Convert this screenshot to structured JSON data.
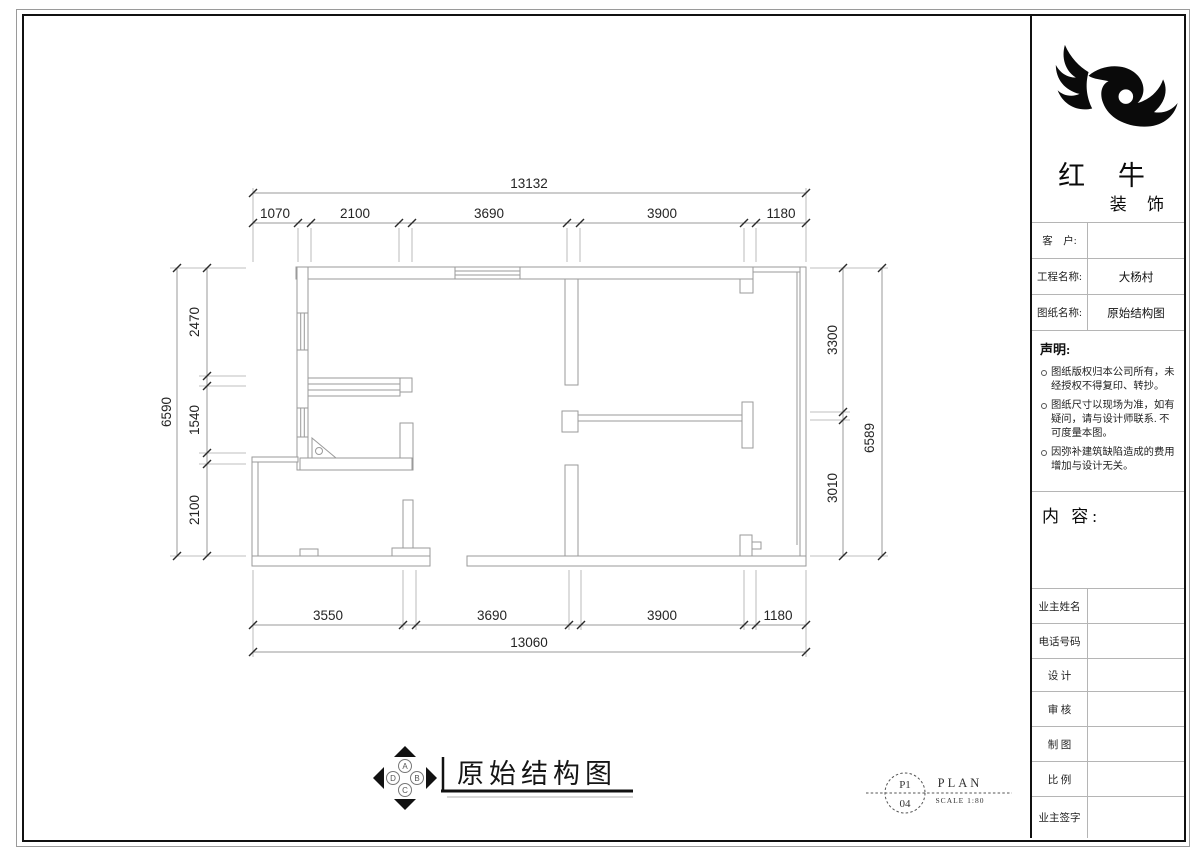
{
  "title_block": {
    "company": {
      "main": "红 牛",
      "sub": "装 饰"
    },
    "fields": [
      {
        "label": "客　户:",
        "value": ""
      },
      {
        "label": "工程名称:",
        "value": "大杨村"
      },
      {
        "label": "图纸名称:",
        "value": "原始结构图"
      }
    ],
    "statement": {
      "heading": "声明:",
      "items": [
        "图纸版权归本公司所有，未经授权不得复印、转抄。",
        "图纸尺寸以现场为准，如有疑问，请与设计师联系. 不可度量本图。",
        "因弥补建筑缺陷造成的费用增加与设计无关。"
      ]
    },
    "content_heading": "内 容:",
    "signature_rows": [
      {
        "label": "业主姓名",
        "value": ""
      },
      {
        "label": "电话号码",
        "value": ""
      },
      {
        "label": "设 计",
        "value": ""
      },
      {
        "label": "审 核",
        "value": ""
      },
      {
        "label": "制 图",
        "value": ""
      },
      {
        "label": "比 例",
        "value": ""
      },
      {
        "label": "业主签字",
        "value": ""
      }
    ]
  },
  "caption": {
    "title": "原始结构图"
  },
  "compass": {
    "letters": [
      "A",
      "B",
      "C",
      "D"
    ]
  },
  "page_ref": {
    "code_top": "P1",
    "code_bottom": "04",
    "type_label": "PLAN",
    "scale_label": "SCALE 1:80"
  },
  "dimensions": {
    "top": {
      "total": "13132",
      "segments": [
        "1070",
        "2100",
        "3690",
        "3900",
        "1180"
      ]
    },
    "bottom": {
      "total": "13060",
      "segments": [
        "3550",
        "3690",
        "3900",
        "1180"
      ]
    },
    "left": {
      "total": "6590",
      "segments": [
        "2470",
        "1540",
        "2100"
      ]
    },
    "right": {
      "total": "6589",
      "segments": [
        "3300",
        "3010"
      ]
    }
  },
  "colors": {
    "wall_line": "#9a9a9a",
    "dim_line": "#9a9a9a",
    "tick": "#2b2b2b",
    "border": "#111111"
  }
}
